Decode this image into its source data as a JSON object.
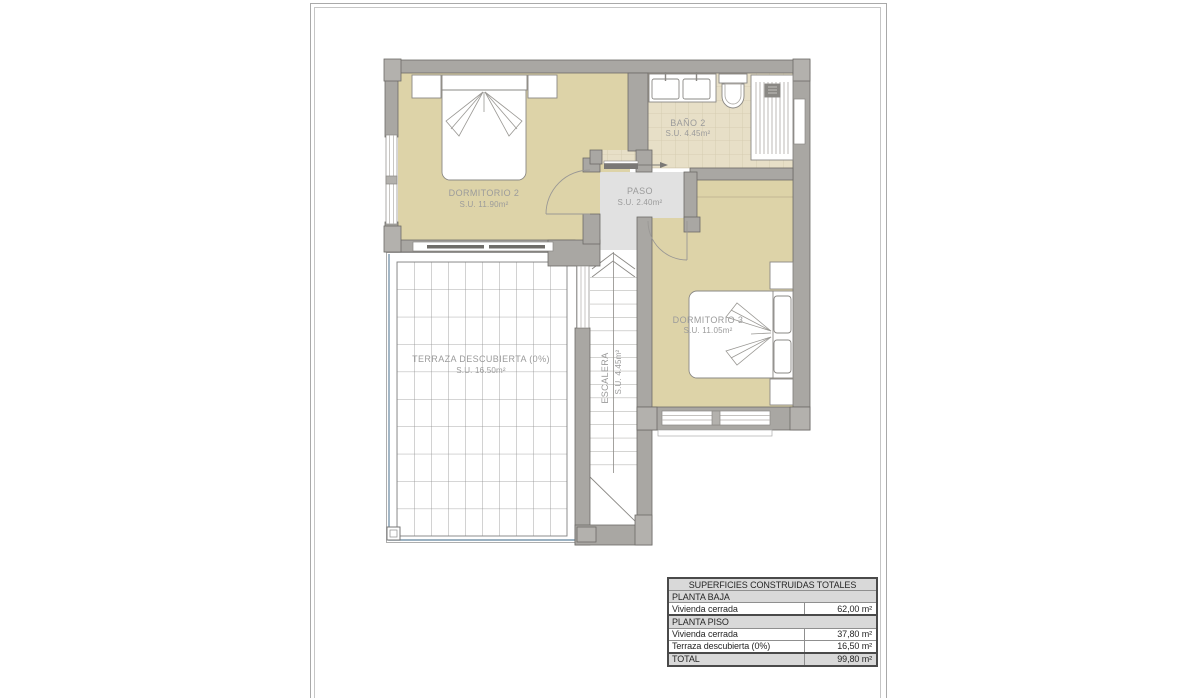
{
  "plan": {
    "rooms": {
      "dormitorio2": {
        "name": "DORMITORIO 2",
        "area": "S.U. 11.90m²"
      },
      "bano2": {
        "name": "BAÑO 2",
        "area": "S.U. 4.45m²"
      },
      "paso": {
        "name": "PASO",
        "area": "S.U. 2.40m²"
      },
      "dormitorio3": {
        "name": "DORMITORIO 3",
        "area": "S.U. 11.05m²"
      },
      "terraza": {
        "name": "TERRAZA DESCUBIERTA (0%)",
        "area": "S.U. 16.50m²"
      },
      "escalera": {
        "name": "ESCALERA",
        "area": "S.U. 4.45m²"
      }
    },
    "colors": {
      "wall": "#a9a7a3",
      "wall_light": "#b3b1ad",
      "floor_bedroom": "#ddd3a8",
      "floor_paso": "#e1e1e1",
      "floor_bath_tile": "#e7dfc7",
      "terrace_edge_blue": "#7c98ae",
      "label_text": "#9b9b9b"
    }
  },
  "summary_table": {
    "title": "SUPERFICIES CONSTRUIDAS TOTALES",
    "rows": [
      {
        "label": "PLANTA BAJA",
        "value": ""
      },
      {
        "label": "Vivienda cerrada",
        "value": "62,00 m²"
      },
      {
        "label": "PLANTA PISO",
        "value": ""
      },
      {
        "label": "Vivienda cerrada",
        "value": "37,80 m²"
      },
      {
        "label": "Terraza descubierta (0%)",
        "value": "16,50 m²"
      },
      {
        "label": "TOTAL",
        "value": "99,80 m²"
      }
    ]
  }
}
